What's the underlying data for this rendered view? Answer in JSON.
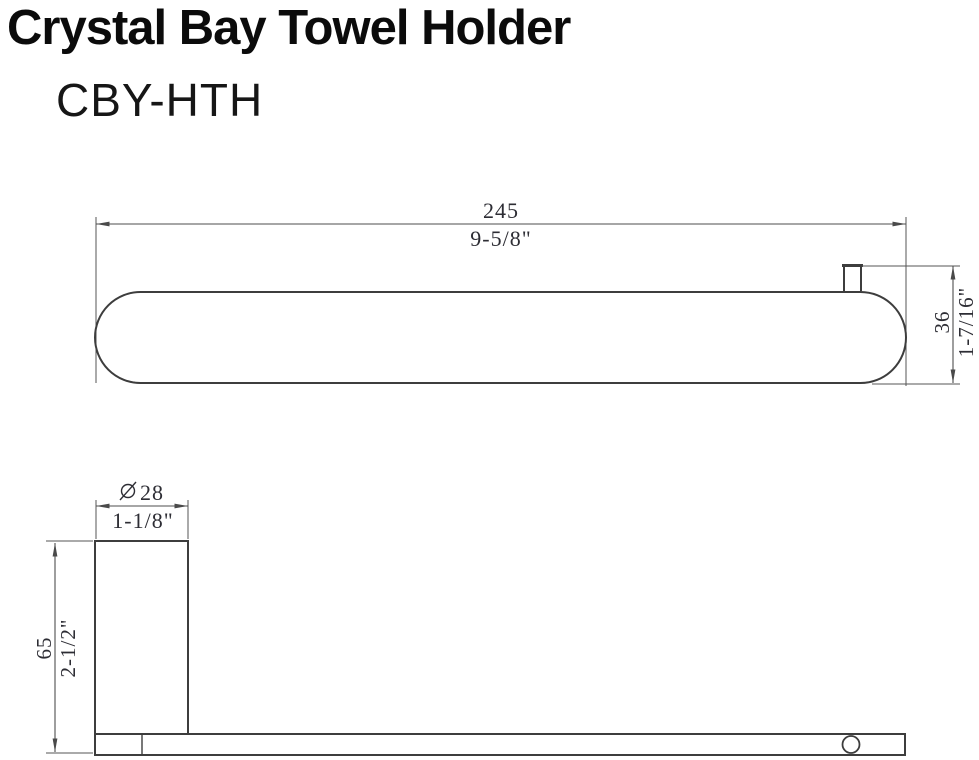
{
  "header": {
    "title": "Crystal Bay Towel Holder",
    "model": "CBY-HTH"
  },
  "drawing": {
    "top_view": {
      "width": {
        "metric": "245",
        "imperial": "9-5/8\""
      },
      "depth": {
        "metric": "36",
        "imperial": "1-7/16\""
      }
    },
    "side_view": {
      "diameter": {
        "symbol": "⌀",
        "metric": "28",
        "imperial": "1-1/8\""
      },
      "height": {
        "metric": "65",
        "imperial": "2-1/2\""
      }
    },
    "colors": {
      "outline": "#3d3d3d",
      "dimension_line": "#4e4e4e",
      "dimension_text": "#2d2d34",
      "title_text": "#0b0b0b",
      "background": "#ffffff"
    }
  }
}
